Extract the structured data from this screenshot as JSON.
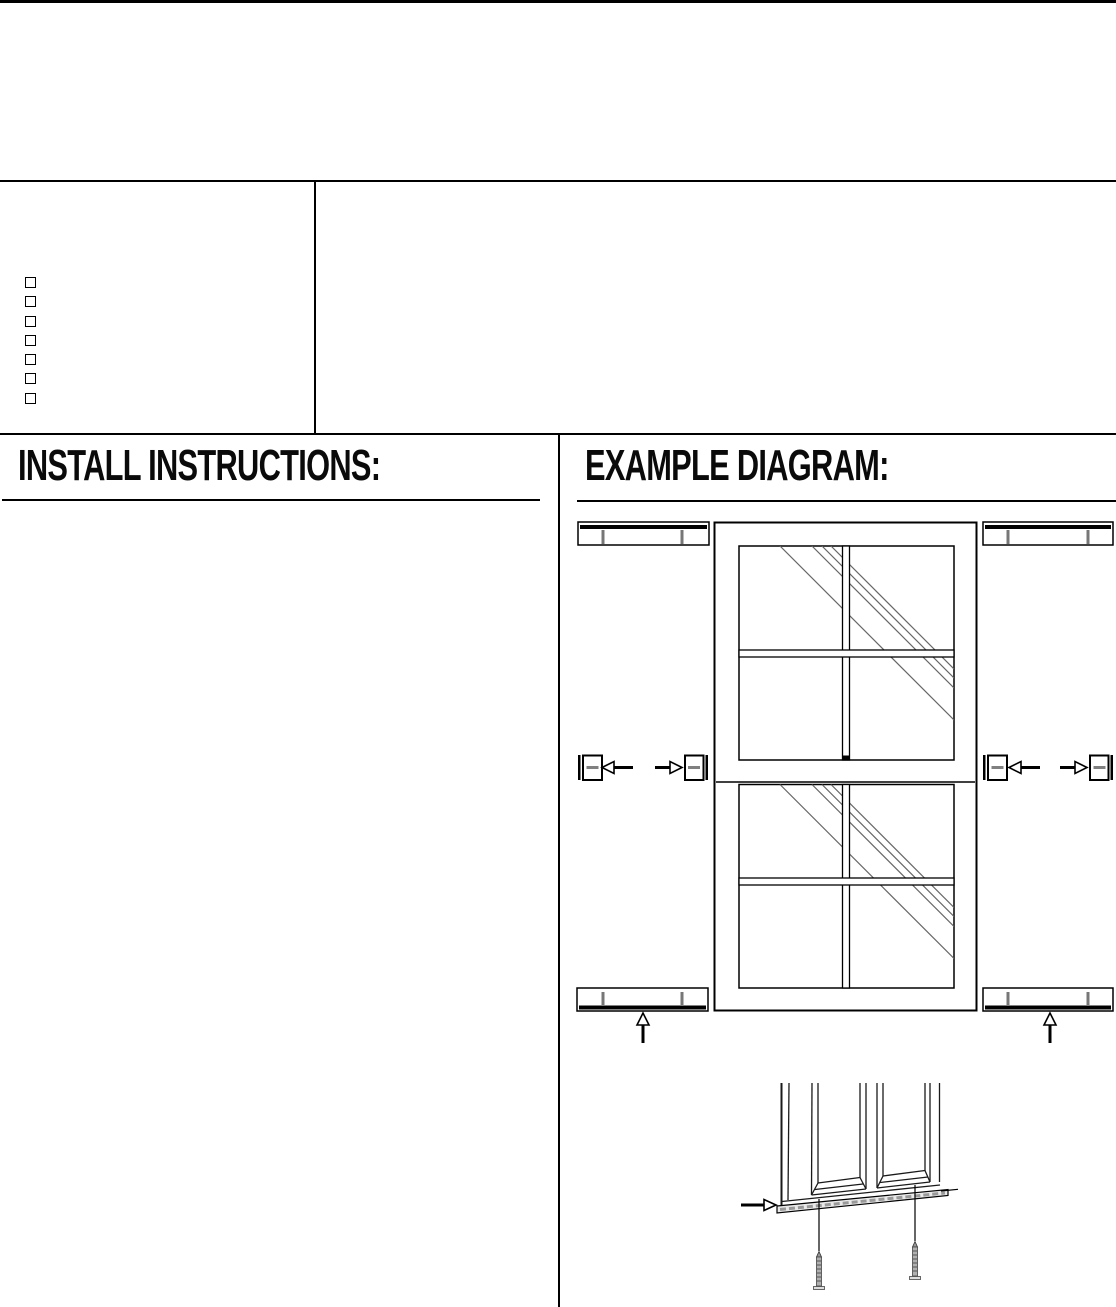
{
  "document": {
    "sections": {
      "install": {
        "heading": "INSTALL INSTRUCTIONS:"
      },
      "example": {
        "heading": "EXAMPLE DIAGRAM:"
      }
    },
    "checklist": {
      "count": 7
    }
  },
  "diagram": {
    "colors": {
      "line": "#000000",
      "tick_gray": "#777777",
      "reflection_gray": "#666666",
      "bracket_pad_gray": "#808080",
      "rail_fill": "#e9e9e9",
      "screw_shaft": "#b0b0b0"
    }
  }
}
